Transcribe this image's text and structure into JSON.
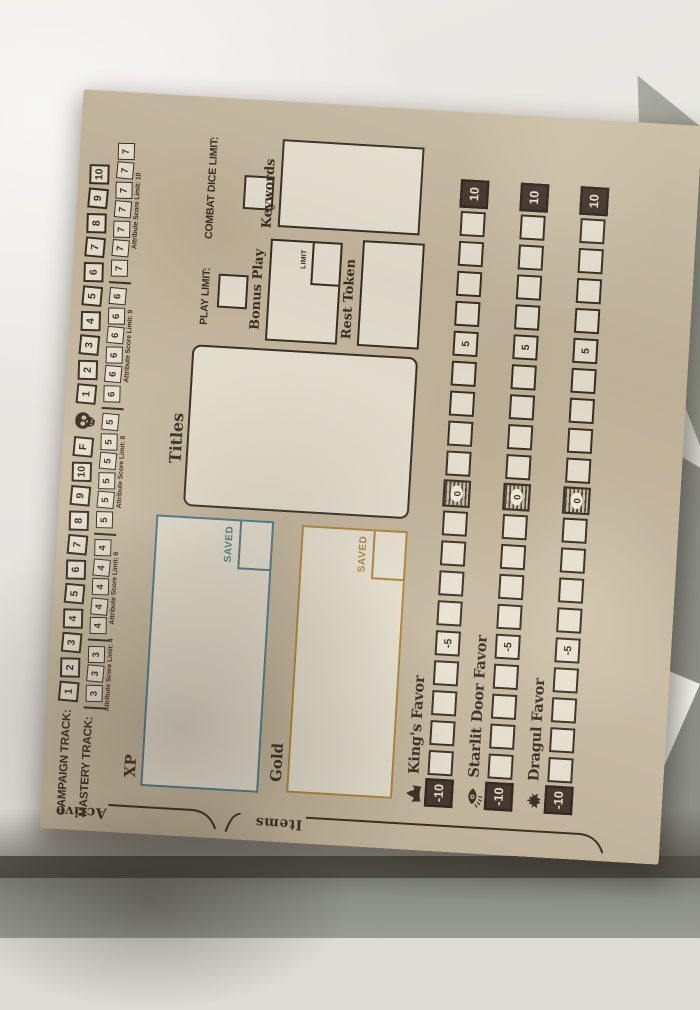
{
  "photo": {
    "surface": "table-top",
    "notes": "paper game sheet lying rotated on a table, shadow at bottom"
  },
  "sheet": {
    "campaign_track": {
      "label": "CAMPAIGN TRACK:",
      "boxes_pre": [
        "1",
        "2",
        "3",
        "4",
        "5",
        "6",
        "7",
        "8",
        "9",
        "10",
        "F"
      ],
      "skull_icon": "skull-icon",
      "boxes_post": [
        "1",
        "2",
        "3",
        "4",
        "5",
        "6",
        "7",
        "8",
        "9",
        "10"
      ]
    },
    "mastery_track": {
      "label": "MASTERY TRACK:",
      "groups": [
        {
          "box": "3",
          "count": 3,
          "limit_label": "Attribute Score Limit: 4"
        },
        {
          "box": "4",
          "count": 5,
          "limit_label": "Attribute Score Limit: 6"
        },
        {
          "box": "5",
          "count": 6,
          "limit_label": "Attribute Score Limit: 8"
        },
        {
          "box": "6",
          "count": 6,
          "limit_label": "Attribute Score Limit: 9"
        },
        {
          "box": "7",
          "count": 7,
          "limit_label": "Attribute Score Limit: 10"
        }
      ]
    },
    "xp": {
      "label": "XP",
      "saved_label": "SAVED"
    },
    "gold": {
      "label": "Gold",
      "saved_label": "SAVED"
    },
    "titles": {
      "label": "Titles"
    },
    "play_limit": {
      "label": "PLAY LIMIT:"
    },
    "combat_dice_limit": {
      "label": "COMBAT DICE LIMIT:"
    },
    "bonus_play": {
      "label": "Bonus Play",
      "limit_label": "LIMIT"
    },
    "rest_token": {
      "label": "Rest Token"
    },
    "keywords": {
      "label": "Keywords"
    },
    "favor_tracks": [
      {
        "icon": "crown-icon",
        "label": "King's Favor",
        "scale": [
          "-10",
          "",
          "",
          "",
          "",
          "-5",
          "",
          "",
          "",
          "",
          "0",
          "",
          "",
          "",
          "",
          "5",
          "",
          "",
          "",
          "",
          "10"
        ]
      },
      {
        "icon": "eye-icon",
        "label": "Starlit Door Favor",
        "scale": [
          "-10",
          "",
          "",
          "",
          "",
          "-5",
          "",
          "",
          "",
          "",
          "0",
          "",
          "",
          "",
          "",
          "5",
          "",
          "",
          "",
          "",
          "10"
        ]
      },
      {
        "icon": "dragon-icon",
        "label": "Dragul Favor",
        "scale": [
          "-10",
          "",
          "",
          "",
          "",
          "-5",
          "",
          "",
          "",
          "",
          "0",
          "",
          "",
          "",
          "",
          "5",
          "",
          "",
          "",
          "",
          "10"
        ]
      }
    ],
    "edge_tabs": [
      {
        "label": "Active"
      },
      {
        "label": "Items"
      }
    ],
    "colors": {
      "ink": "#3a2d22",
      "paper": "#c7b99f",
      "box_fill": "#eae3d2",
      "xp_accent": "#4d7a8c",
      "gold_accent": "#b08437",
      "dark_box": "#44342a"
    }
  }
}
